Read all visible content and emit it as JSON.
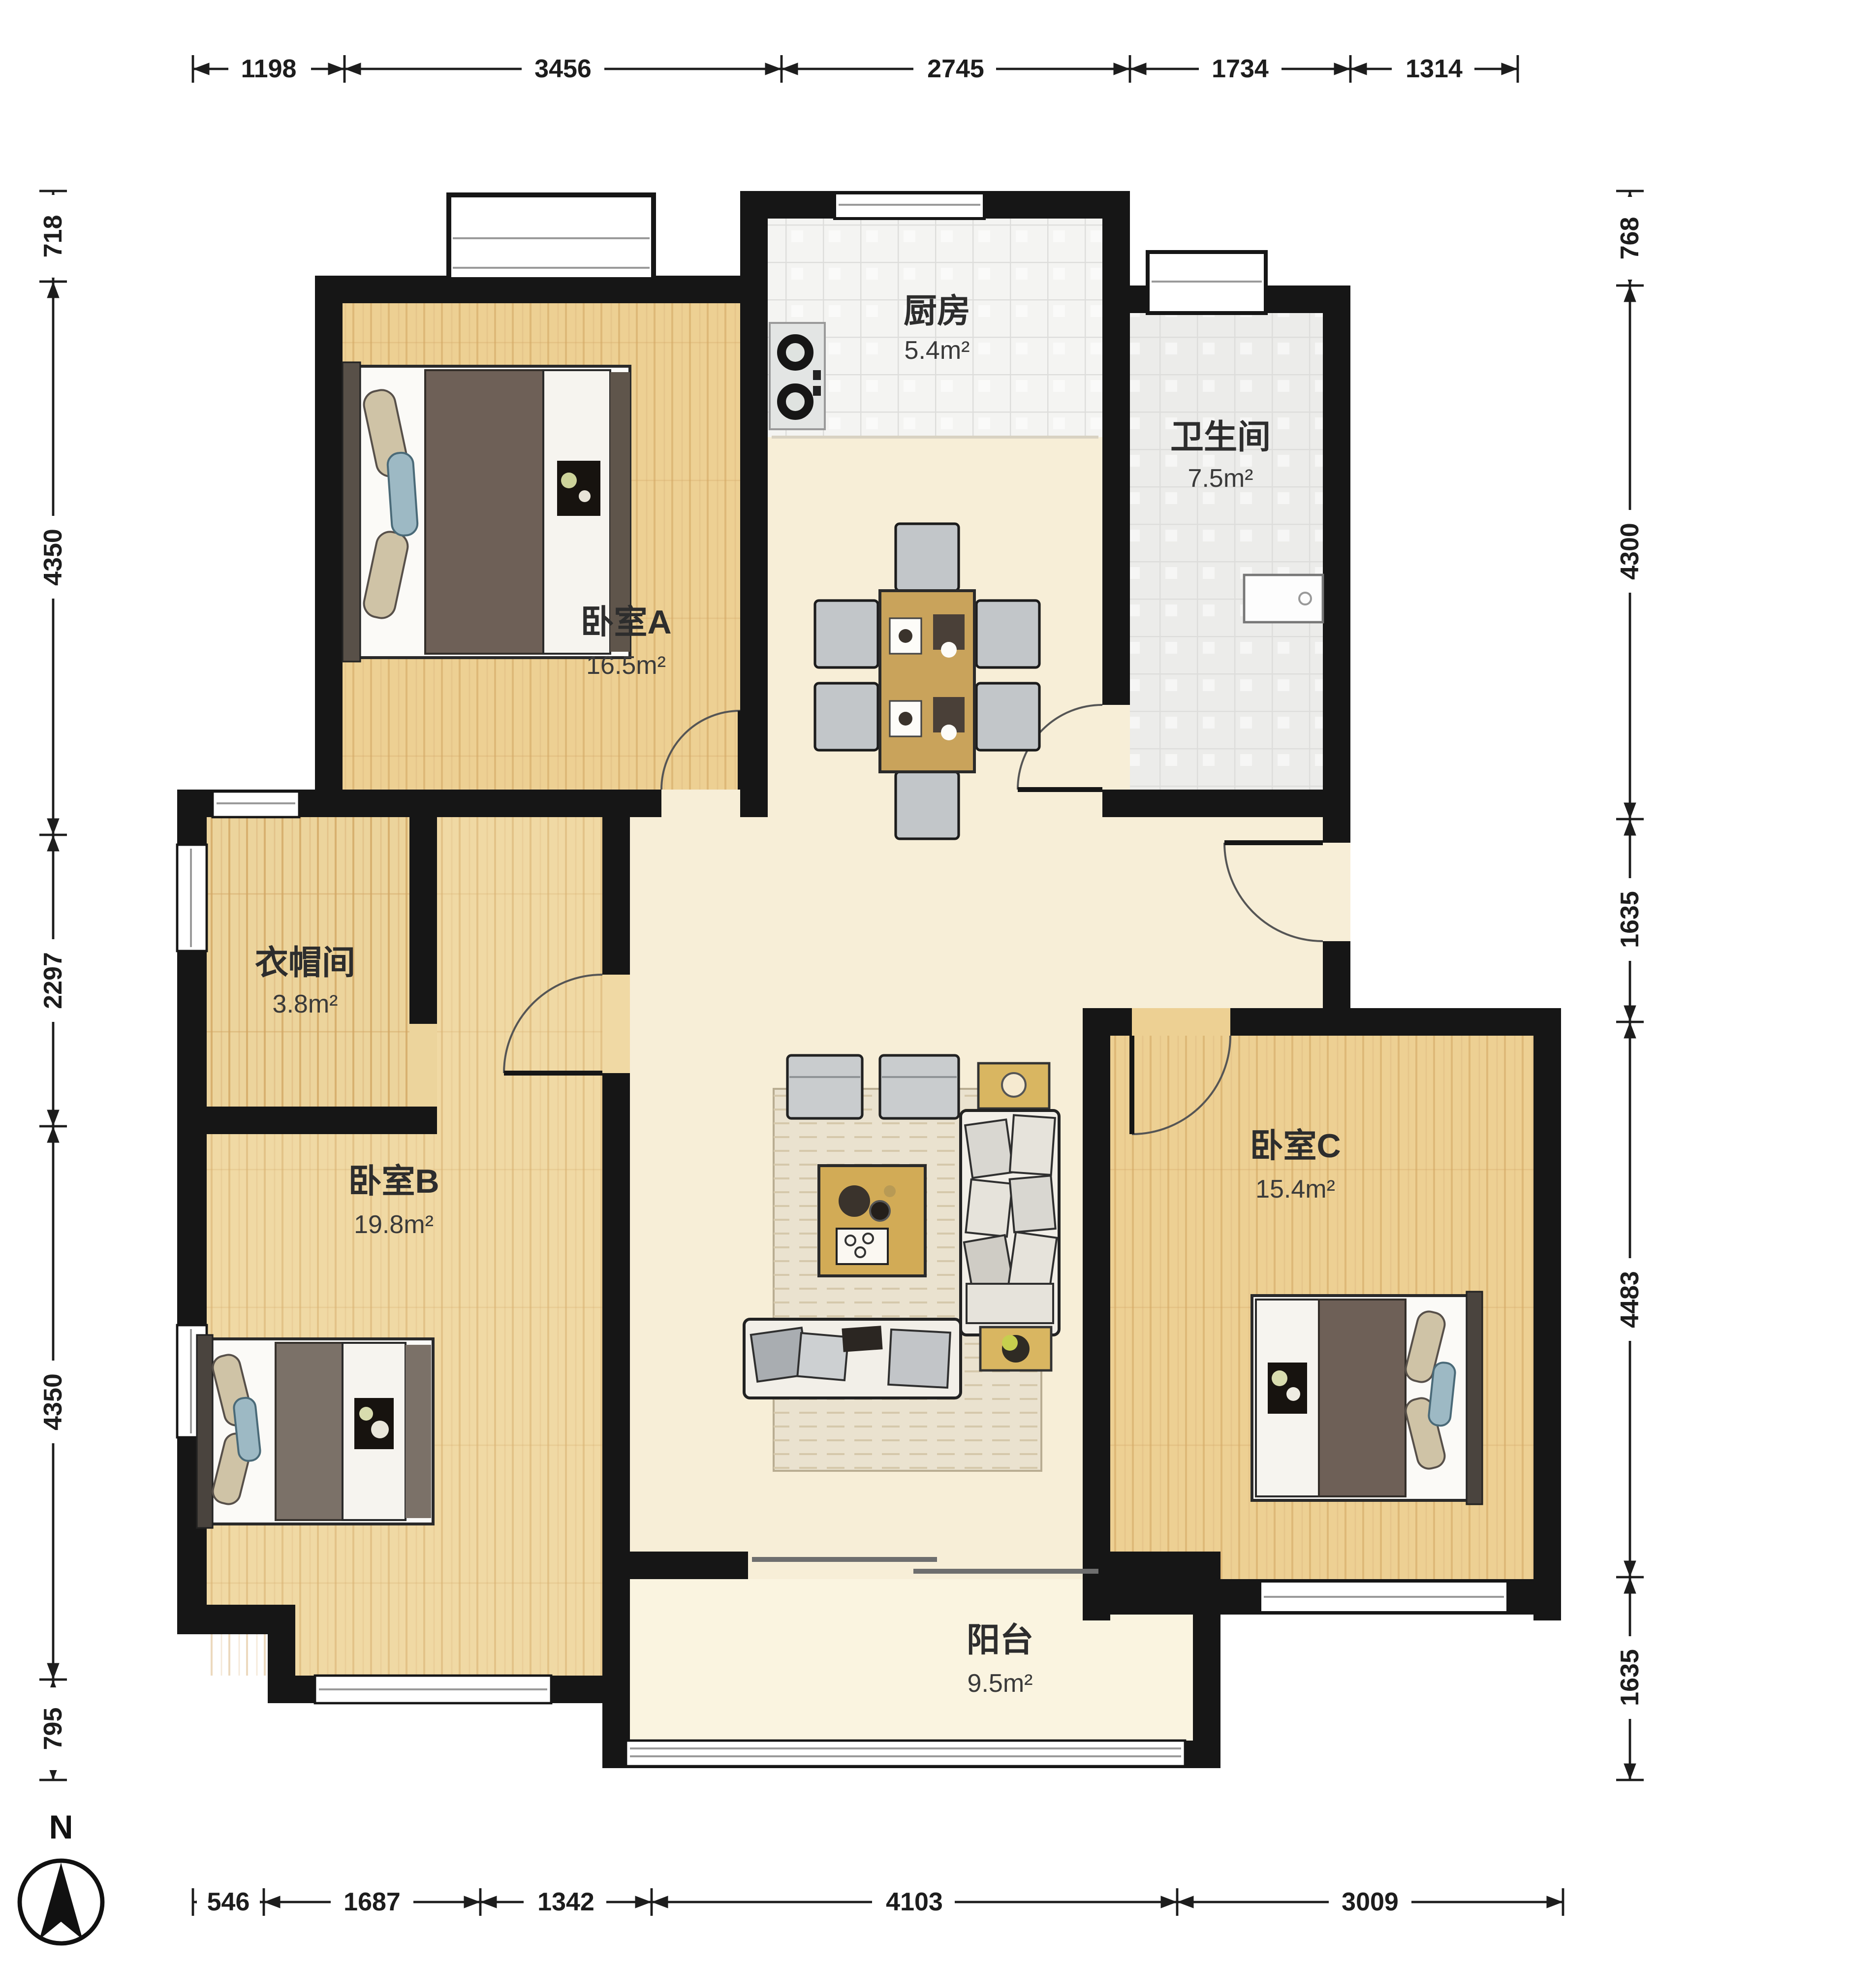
{
  "compass": {
    "north_label": "N"
  },
  "rooms": {
    "kitchen": {
      "name": "厨房",
      "area": "5.4m²"
    },
    "bathroom": {
      "name": "卫生间",
      "area": "7.5m²"
    },
    "bedroomA": {
      "name": "卧室A",
      "area": "16.5m²"
    },
    "cloakroom": {
      "name": "衣帽间",
      "area": "3.8m²"
    },
    "bedroomB": {
      "name": "卧室B",
      "area": "19.8m²"
    },
    "bedroomC": {
      "name": "卧室C",
      "area": "15.4m²"
    },
    "balcony": {
      "name": "阳台",
      "area": "9.5m²"
    }
  },
  "dimensions": {
    "top": [
      "1198",
      "3456",
      "2745",
      "1734",
      "1314"
    ],
    "left": [
      "718",
      "4350",
      "2297",
      "4350",
      "795"
    ],
    "right": [
      "768",
      "4300",
      "1635",
      "4483",
      "1635"
    ],
    "bottom": [
      "546",
      "1687",
      "1342",
      "4103",
      "3009"
    ]
  },
  "colors": {
    "wall": "#161616",
    "wood_floor": "#edd093",
    "hall_floor": "#f7eed7",
    "kitchen_tile": "#f4f4f2",
    "bath_tile": "#ececea",
    "balcony_floor": "#faf4e0",
    "table_gold": "#c9a35b",
    "sofa_white": "#f2efe8",
    "chair_gray": "#c2c6c9",
    "duvet_brown": "#6e6057"
  }
}
